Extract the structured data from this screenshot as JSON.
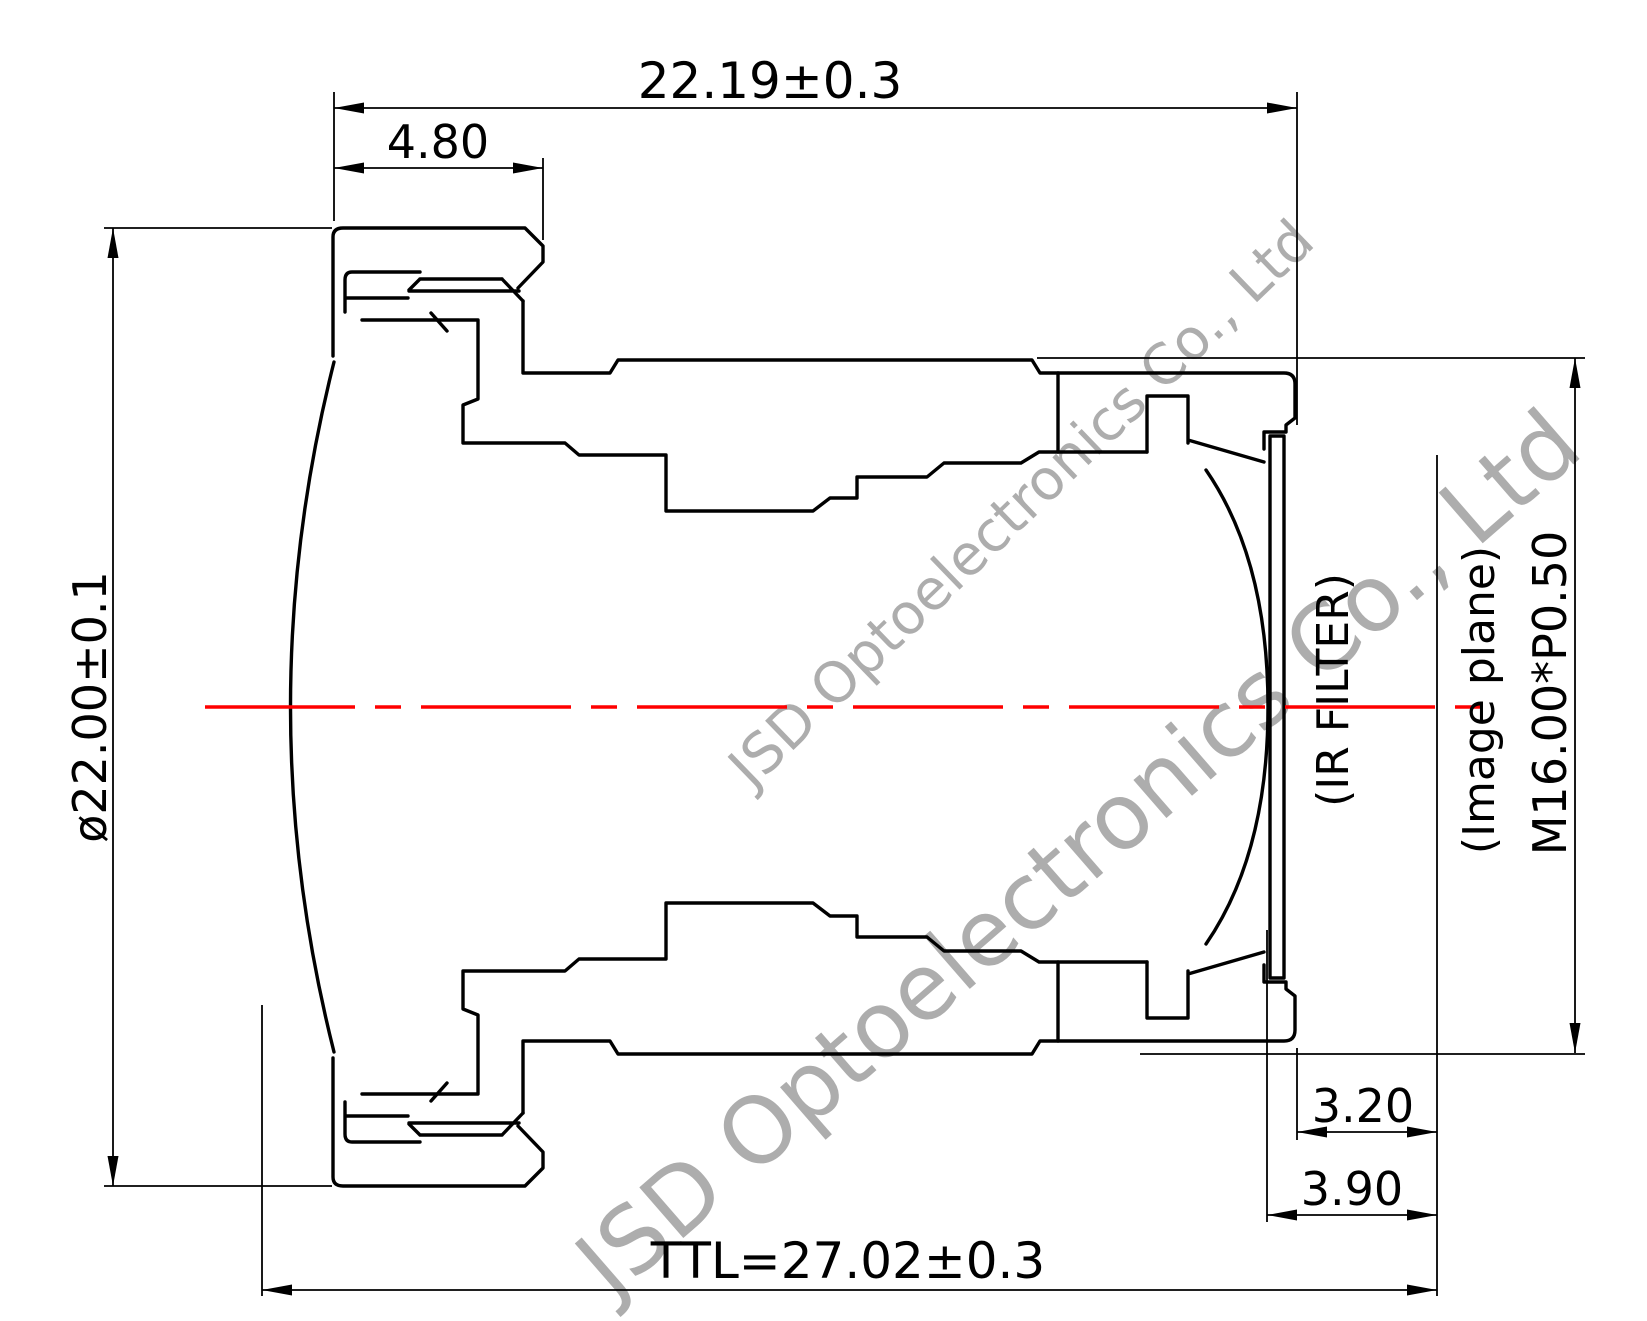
{
  "title": "Lens barrel cross-section mechanical drawing",
  "company": "JSD Optoelectronics Co., Ltd",
  "dimensions": {
    "overall_width": "22.19±0.3",
    "front_cap_width": "4.80",
    "outer_diameter": "ø22.00±0.1",
    "ir_filter_label": "(IR FILTER)",
    "image_plane_label": "(Image plane)",
    "mount_thread": "M16.00*P0.50",
    "filter_to_image_plane": "3.20",
    "filter_front_to_image_plane": "3.90",
    "total_track_length": "TTL=27.02±0.3"
  },
  "colors": {
    "outline": "#000000",
    "centerline": "#ff0000",
    "watermark": "#a9a9a9",
    "background": "#ffffff"
  }
}
